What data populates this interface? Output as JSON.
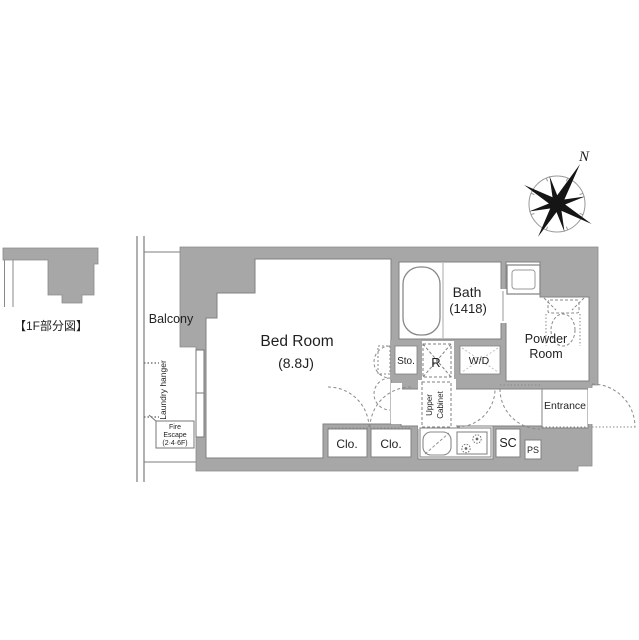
{
  "colors": {
    "wall_fill": "#a7a7a7",
    "room_outline": "#808080",
    "dashed_line": "#8a8a8a",
    "fixture_line": "#888888",
    "text": "#1f1f1f"
  },
  "labels": {
    "partial_plan": "【1F部分図】",
    "compass_n": "N",
    "balcony": "Balcony",
    "laundry_hanger": "Laundry hanger",
    "fire_escape_line1": "Fire",
    "fire_escape_line2": "Escape",
    "fire_escape_line3": "(2·4·6F)",
    "bedroom_name": "Bed Room",
    "bedroom_size": "(8.8J)",
    "bath_name": "Bath",
    "bath_size": "(1418)",
    "powder_room_line1": "Powder",
    "powder_room_line2": "Room",
    "entrance": "Entrance",
    "storage": "Sto.",
    "refrigerator": "R",
    "washer_dryer": "W/D",
    "upper_cabinet_line1": "Upper",
    "upper_cabinet_line2": "Cabinet",
    "closet_1": "Clo.",
    "closet_2": "Clo.",
    "shoe_cabinet": "SC",
    "pipe_space": "PS"
  }
}
